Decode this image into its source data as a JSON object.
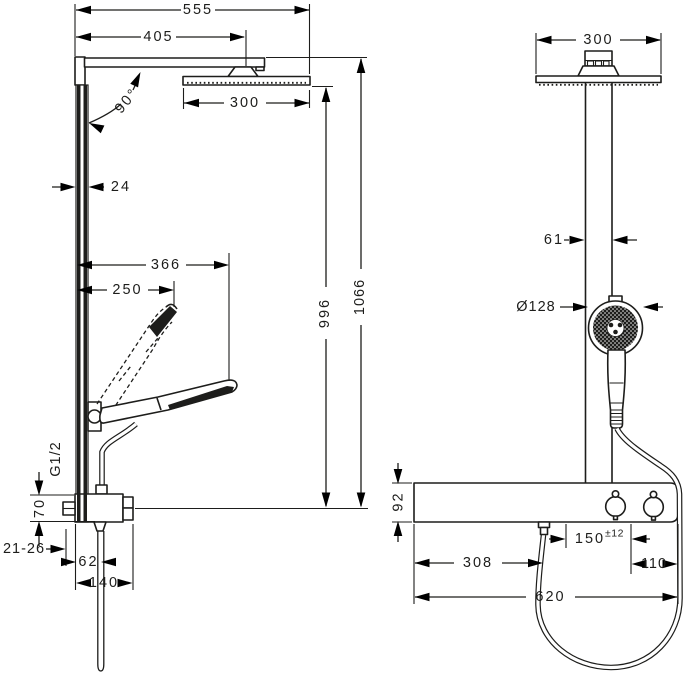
{
  "drawing": {
    "description": "Shower pipe technical dimension drawing, side view and front view",
    "colors": {
      "line": "#1d1d1b",
      "background": "#ffffff"
    },
    "side": {
      "total_width": "555",
      "arm_projection": "405",
      "overhead_width": "300",
      "arm_angle": "90°",
      "bar_depth": "24",
      "hand_reach": "366",
      "hand_length": "250",
      "head_height": "996",
      "total_height": "1066",
      "thread": "G1/2",
      "valve_height": "70",
      "wall_adjust": "21-26",
      "outlet_offset": "62",
      "valve_depth": "140"
    },
    "front": {
      "overhead_width": "300",
      "pipe_width": "61",
      "hand_diameter": "Ø128",
      "shelf_height": "92",
      "supply_spacing": "150",
      "supply_tolerance": "±12",
      "inlet_offset": "308",
      "right_offset": "110",
      "shelf_width": "620"
    }
  }
}
